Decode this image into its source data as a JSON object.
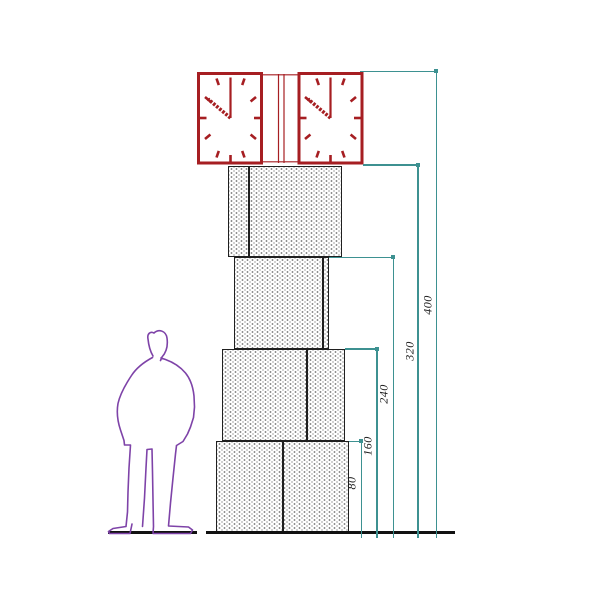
{
  "drawing": {
    "kind": "clock-tower elevation with human figure for scale",
    "dimensions": {
      "labels": [
        "80",
        "160",
        "240",
        "320",
        "400"
      ]
    },
    "clock": {
      "faces": 2,
      "time_shown": "10:00"
    },
    "blocks_count": 4,
    "colors": {
      "clock_red": "#a61e22",
      "dimension_teal": "#3d9191",
      "figure_purple": "#7e43a8",
      "block_outline": "#1f1f1f",
      "ground_black": "#111111"
    }
  }
}
